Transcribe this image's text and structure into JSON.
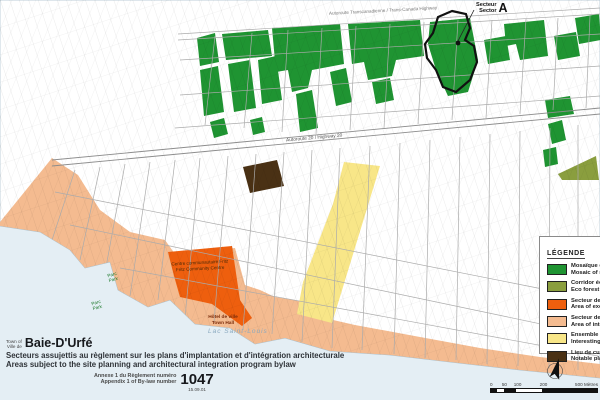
{
  "colors": {
    "green": "#1f9432",
    "olive": "#8a9e3e",
    "orange": "#ee5f0e",
    "salmon": "#f4bb90",
    "yellow": "#f8e688",
    "brown": "#4a3114",
    "lake": "#e4eef4",
    "white_land": "#ffffff"
  },
  "map": {
    "sector_callout": {
      "line_fr": "Secteur",
      "line_en": "Sector",
      "letter": "A"
    },
    "labels": {
      "transcanada": "Autoroute Transcanadienne / Trans-Canada Highway",
      "highway20": "Autoroute 20 / Highway 20",
      "community_centre_fr": "Centre communautaire Fritz",
      "community_centre_en": "Fritz Community Centre",
      "town_hall_fr": "Hôtel de ville",
      "town_hall_en": "Town Hall",
      "lake": "Lac Saint-Louis",
      "park1_fr": "Parc",
      "park1_en": "Park",
      "park2_fr": "Parc",
      "park2_en": "Park"
    }
  },
  "legend": {
    "title": "LÉGENDE",
    "items": [
      {
        "fr": "Mosaïque de milieux naturels",
        "en": "Mosaic of natural areas"
      },
      {
        "fr": "Corridor écoforestier",
        "en": "Eco forest corridor"
      },
      {
        "fr": "Secteur de valeur exceptionnelle",
        "en": "Area of exceptional value"
      },
      {
        "fr": "Secteur de valeur intéressante",
        "en": "Area of interest"
      },
      {
        "fr": "Ensemble urbain intéressant",
        "en": "Interesting urban ensemble"
      },
      {
        "fr": "Lieu de culte notable",
        "en": "Notable place of worship"
      }
    ]
  },
  "title_block": {
    "town_of_line1": "Town of",
    "town_of_line2": "Ville de",
    "name": "Baie-D'Urfé",
    "subtitle_fr": "Secteurs assujettis au règlement sur les plans d'implantation et d'intégration architecturale",
    "subtitle_en": "Areas subject to the site planning and architectural integration program bylaw",
    "annexe_line1": "Annexe 1 du Règlement numéro",
    "annexe_line2": "Appendix 1 of By-law number",
    "bylaw_number": "1047",
    "date": "15.09.01"
  },
  "scale_bar": {
    "t0": "0",
    "t1": "50",
    "t2": "100",
    "t3": "200",
    "t4": "500 Mètres"
  }
}
